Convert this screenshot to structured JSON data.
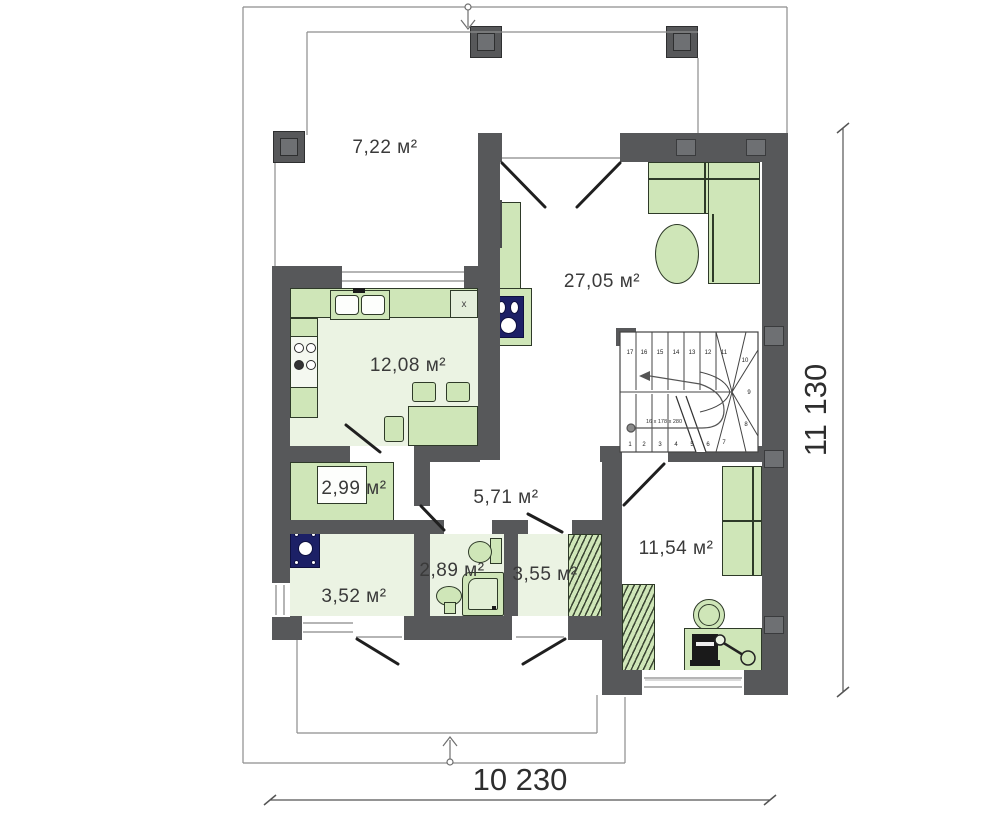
{
  "rooms": {
    "terrace": "7,22 м²",
    "living": "27,05 м²",
    "kitchen": "12,08 м²",
    "pantry": "2,99 м²",
    "hallway": "5,71 м²",
    "laundry": "3,52 м²",
    "bathroom": "2,89 м²",
    "closet": "3,55 м²",
    "bedroom": "11,54 м²"
  },
  "dimensions": {
    "bottom": "10 230",
    "right": "11 130"
  },
  "stairs": {
    "note": "16 x 178 x 280",
    "steps": [
      "1",
      "2",
      "3",
      "4",
      "5",
      "6",
      "7",
      "8",
      "9",
      "10",
      "11",
      "12",
      "13",
      "14",
      "15",
      "16",
      "17"
    ]
  },
  "markers": {
    "fridge": "x"
  },
  "colors": {
    "wall": "#57585a",
    "furniture_fill": "#cfe6b8",
    "furniture_stroke": "#2e3a28",
    "floor_tint": "#ebf3e3",
    "appliance_navy": "#1c2066",
    "thin_line": "#8d8d8d",
    "dimension_text": "#2e2e2e"
  }
}
